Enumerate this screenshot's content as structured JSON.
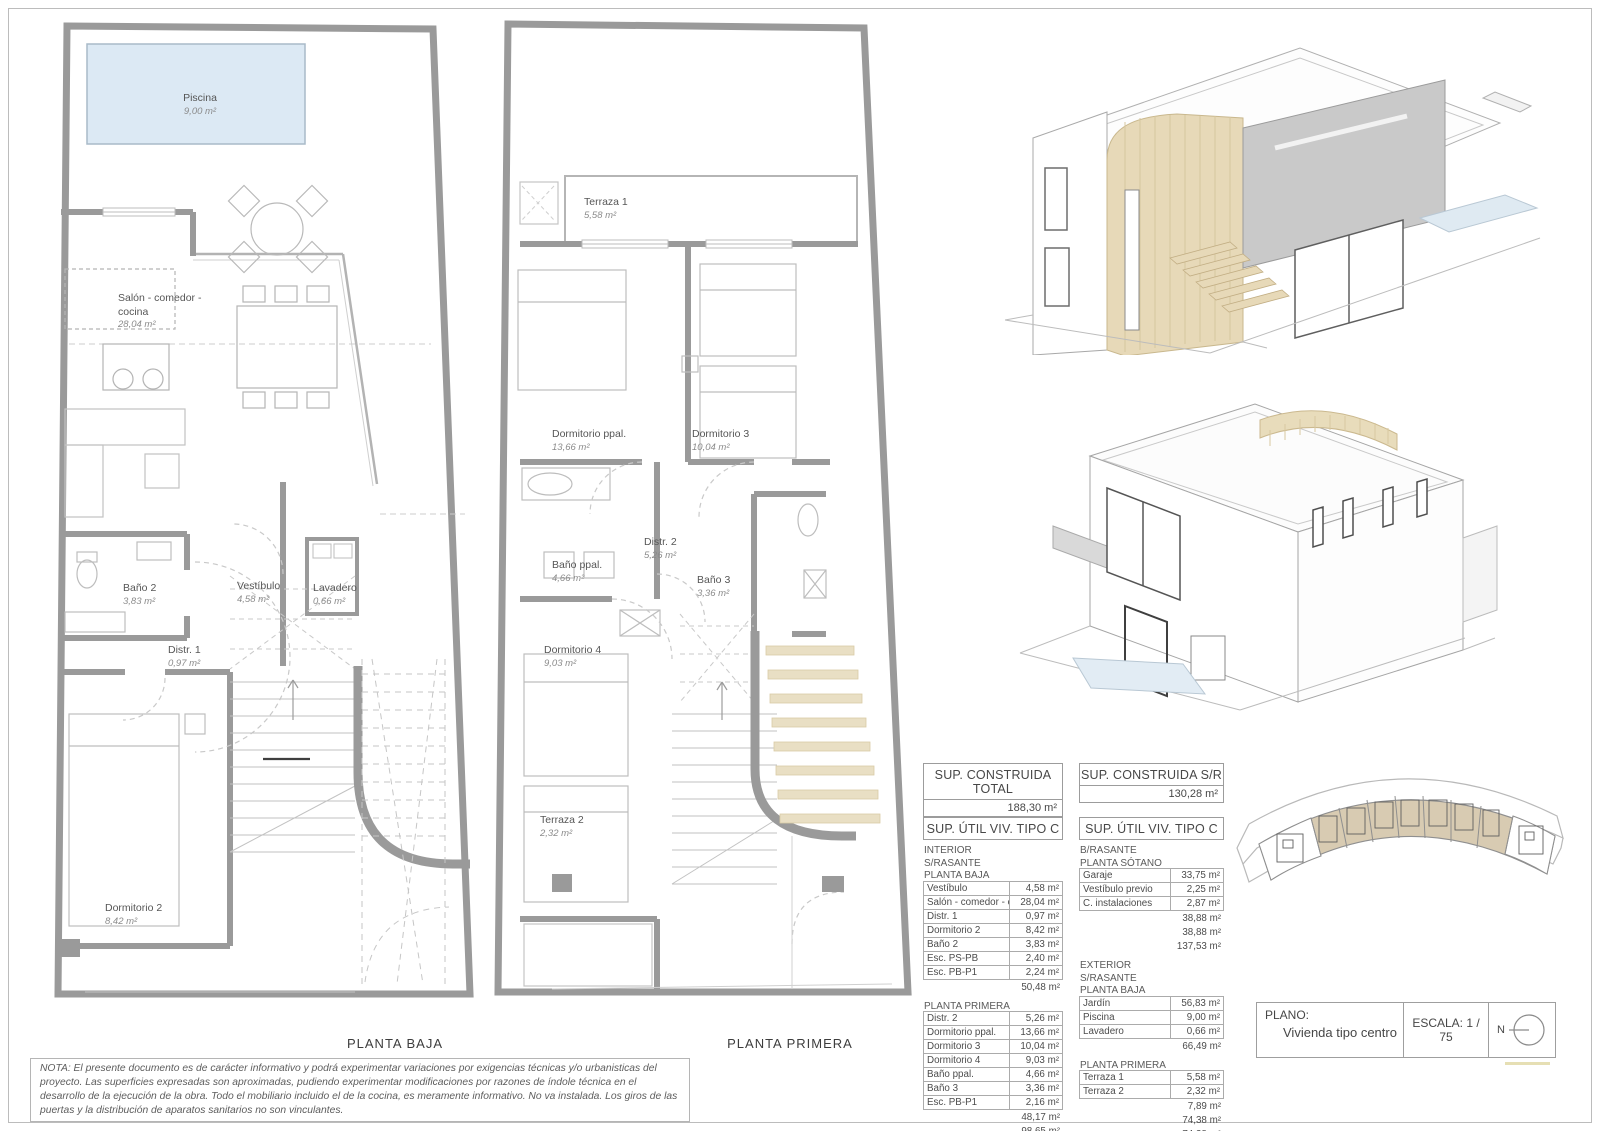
{
  "sheet": {
    "plan_baja_caption": "PLANTA BAJA",
    "plan_primera_caption": "PLANTA PRIMERA",
    "note": "NOTA: El presente documento es de carácter informativo y podrá experimentar variaciones por exigencias técnicas y/o urbanisticas del proyecto. Las superficies expresadas son aproximadas, pudiendo experimentar modificaciones por razones de índole técnica en el desarrollo de la ejecución de la obra. Todo el mobiliario incluido el de la cocina, es meramente informativo. No va instalada. Los giros de las puertas y la distribución de aparatos sanitarios no son vinculantes."
  },
  "plan_baja": {
    "rooms": {
      "piscina": {
        "name": "Piscina",
        "area": "9,00 m²"
      },
      "salon": {
        "name": "Salón - comedor -",
        "name2": "cocina",
        "area": "28,04 m²"
      },
      "bano2": {
        "name": "Baño 2",
        "area": "3,83 m²"
      },
      "distr1": {
        "name": "Distr. 1",
        "area": "0,97 m²"
      },
      "vestibulo": {
        "name": "Vestíbulo",
        "area": "4,58 m²"
      },
      "lavadero": {
        "name": "Lavadero",
        "area": "0,66 m²"
      },
      "dormitorio2": {
        "name": "Dormitorio 2",
        "area": "8,42 m²"
      }
    }
  },
  "plan_primera": {
    "rooms": {
      "terraza1": {
        "name": "Terraza 1",
        "area": "5,58 m²"
      },
      "dormppal": {
        "name": "Dormitorio ppal.",
        "area": "13,66 m²"
      },
      "dorm3": {
        "name": "Dormitorio 3",
        "area": "10,04 m²"
      },
      "banoppal": {
        "name": "Baño ppal.",
        "area": "4,66 m²"
      },
      "distr2": {
        "name": "Distr. 2",
        "area": "5,26 m²"
      },
      "bano3": {
        "name": "Baño 3",
        "area": "3,36 m²"
      },
      "dorm4": {
        "name": "Dormitorio 4",
        "area": "9,03 m²"
      },
      "terraza2": {
        "name": "Terraza 2",
        "area": "2,32 m²"
      }
    }
  },
  "tables": {
    "construida_total": {
      "header": "SUP. CONSTRUIDA TOTAL",
      "value": "188,30 m²"
    },
    "construida_sr": {
      "header": "SUP. CONSTRUIDA S/R",
      "value": "130,28 m²"
    },
    "util_left": {
      "header": "SUP. ÚTIL VIV. TIPO C",
      "sec1_titles": [
        "INTERIOR",
        "S/RASANTE",
        "PLANTA BAJA"
      ],
      "sec1_rows": [
        {
          "n": "Vestíbulo",
          "v": "4,58 m²"
        },
        {
          "n": "Salón - comedor - cocina",
          "v": "28,04 m²"
        },
        {
          "n": "Distr. 1",
          "v": "0,97 m²"
        },
        {
          "n": "Dormitorio 2",
          "v": "8,42 m²"
        },
        {
          "n": "Baño 2",
          "v": "3,83 m²"
        },
        {
          "n": "Esc. PS-PB",
          "v": "2,40 m²"
        },
        {
          "n": "Esc. PB-P1",
          "v": "2,24 m²"
        }
      ],
      "sec1_total": "50,48 m²",
      "sec2_title": "PLANTA PRIMERA",
      "sec2_rows": [
        {
          "n": "Distr. 2",
          "v": "5,26 m²"
        },
        {
          "n": "Dormitorio ppal.",
          "v": "13,66 m²"
        },
        {
          "n": "Dormitorio 3",
          "v": "10,04 m²"
        },
        {
          "n": "Dormitorio 4",
          "v": "9,03 m²"
        },
        {
          "n": "Baño ppal.",
          "v": "4,66 m²"
        },
        {
          "n": "Baño 3",
          "v": "3,36 m²"
        },
        {
          "n": "Esc. PB-P1",
          "v": "2,16 m²"
        }
      ],
      "sec2_totals": [
        "48,17 m²",
        "98,65 m²"
      ]
    },
    "util_right": {
      "header": "SUP. ÚTIL VIV. TIPO C",
      "sec1_titles": [
        "B/RASANTE",
        "PLANTA SÓTANO"
      ],
      "sec1_rows": [
        {
          "n": "Garaje",
          "v": "33,75 m²"
        },
        {
          "n": "Vestíbulo previo",
          "v": "2,25 m²"
        },
        {
          "n": "C. instalaciones",
          "v": "2,87 m²"
        }
      ],
      "sec1_totals": [
        "38,88 m²",
        "38,88 m²",
        "137,53 m²"
      ],
      "sec2_titles": [
        "EXTERIOR",
        "S/RASANTE",
        "PLANTA BAJA"
      ],
      "sec2_rows": [
        {
          "n": "Jardín",
          "v": "56,83 m²"
        },
        {
          "n": "Piscina",
          "v": "9,00 m²"
        },
        {
          "n": "Lavadero",
          "v": "0,66 m²"
        }
      ],
      "sec2_total": "66,49 m²",
      "sec3_title": "PLANTA PRIMERA",
      "sec3_rows": [
        {
          "n": "Terraza 1",
          "v": "5,58 m²"
        },
        {
          "n": "Terraza 2",
          "v": "2,32 m²"
        }
      ],
      "sec3_totals": [
        "7,89 m²",
        "74,38 m²",
        "74,38 m²"
      ]
    }
  },
  "titleblock": {
    "plano_label": "PLANO:",
    "plano_value": "Vivienda tipo centro",
    "escala": "ESCALA:  1 / 75",
    "north": "N"
  },
  "colors": {
    "wall_gray": "#9a9a9a",
    "pool_blue": "#dce9f4",
    "wood_tan": "#e7d9b8",
    "site_tan": "#d8cbb2"
  }
}
